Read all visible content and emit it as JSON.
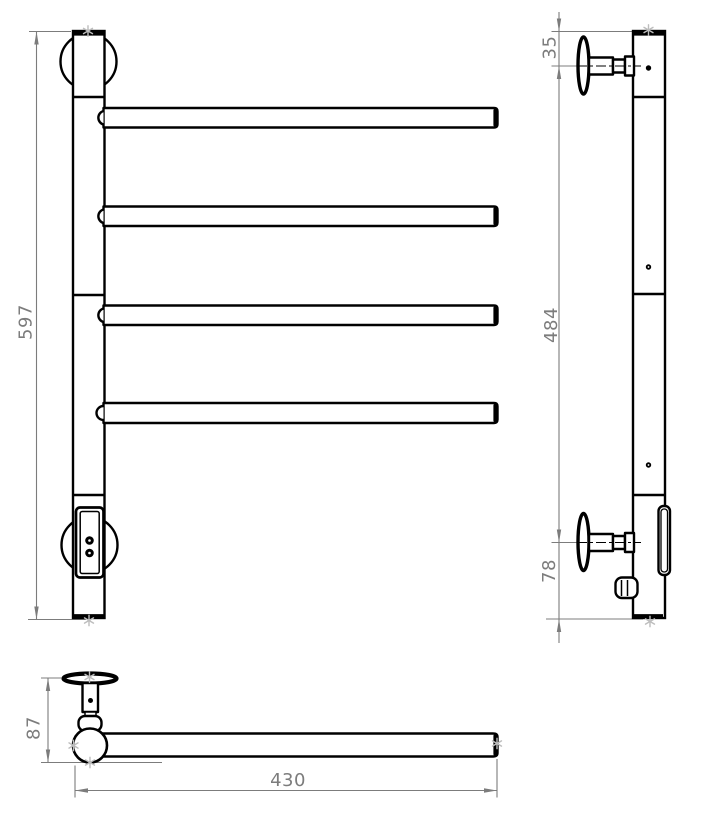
{
  "dimensions": {
    "front_height": "597",
    "side_top_offset": "35",
    "side_bracket_span": "484",
    "side_bottom_offset": "78",
    "top_depth": "87",
    "top_bar_length": "430"
  },
  "colors": {
    "outline": "#000000",
    "dimension_line": "#7c7c7c",
    "dimension_text": "#7c7c7c",
    "endpoint_marker": "#bdbdbd",
    "background": "#ffffff"
  },
  "icons": {
    "endpoint_marker": "asterisk",
    "screw_hole": "dot",
    "center_line": "dash-dot"
  }
}
